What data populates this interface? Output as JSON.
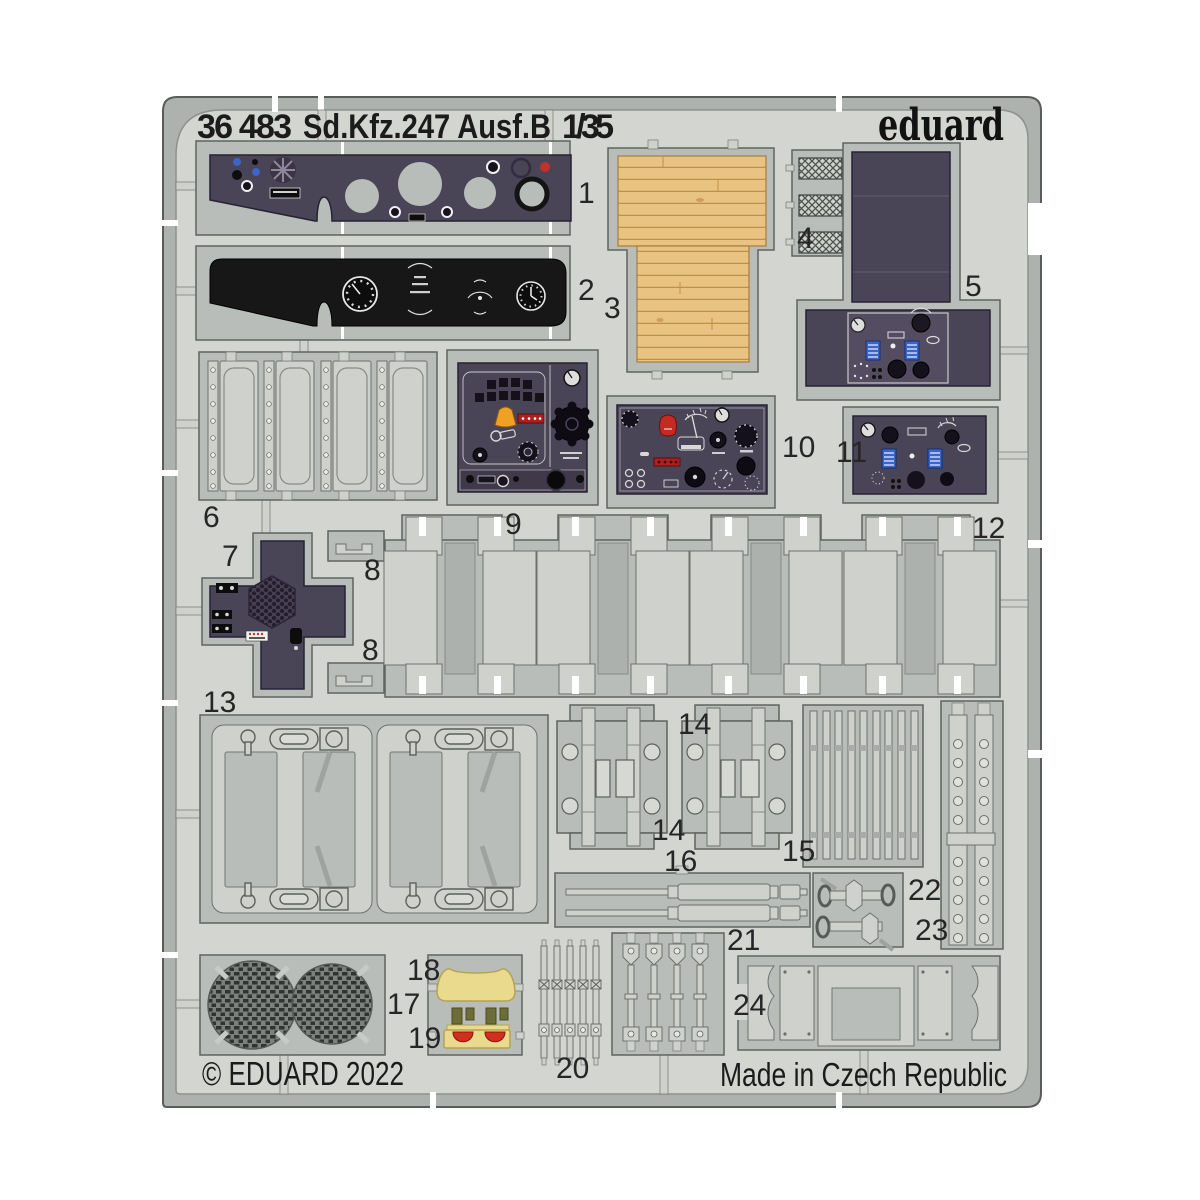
{
  "header": {
    "catalog_number": "36 483",
    "product_title": "Sd.Kfz.247 Ausf.B",
    "scale": "1/35",
    "brand_logo": "eduard"
  },
  "footer": {
    "copyright": "© EDUARD 2022",
    "made_in": "Made in Czech Republic"
  },
  "part_labels": {
    "p1": "1",
    "p2": "2",
    "p3": "3",
    "p4": "4",
    "p5": "5",
    "p6": "6",
    "p7": "7",
    "p8_top": "8",
    "p8_bottom": "8",
    "p9": "9",
    "p10": "10",
    "p11": "11",
    "p12": "12",
    "p13": "13",
    "p14_top": "14",
    "p14_bottom": "14",
    "p15": "15",
    "p16": "16",
    "p17": "17",
    "p18": "18",
    "p19": "19",
    "p20": "20",
    "p21": "21",
    "p22": "22",
    "p23": "23",
    "p24": "24"
  },
  "colors": {
    "fret_surface": "#d3d5d1",
    "fret_rim": "#aeb2ae",
    "part_frame_grey": "#b9bdb9",
    "prepainted_panel_purple": "#4a4457",
    "prepainted_panel_black": "#171717",
    "wood_panel": "#e9c382",
    "accent_red": "#c23227",
    "accent_amber": "#f0a124",
    "accent_blue": "#3a66c8",
    "accent_yellow": "#e9da8e",
    "accent_olive": "#6d6d38"
  }
}
